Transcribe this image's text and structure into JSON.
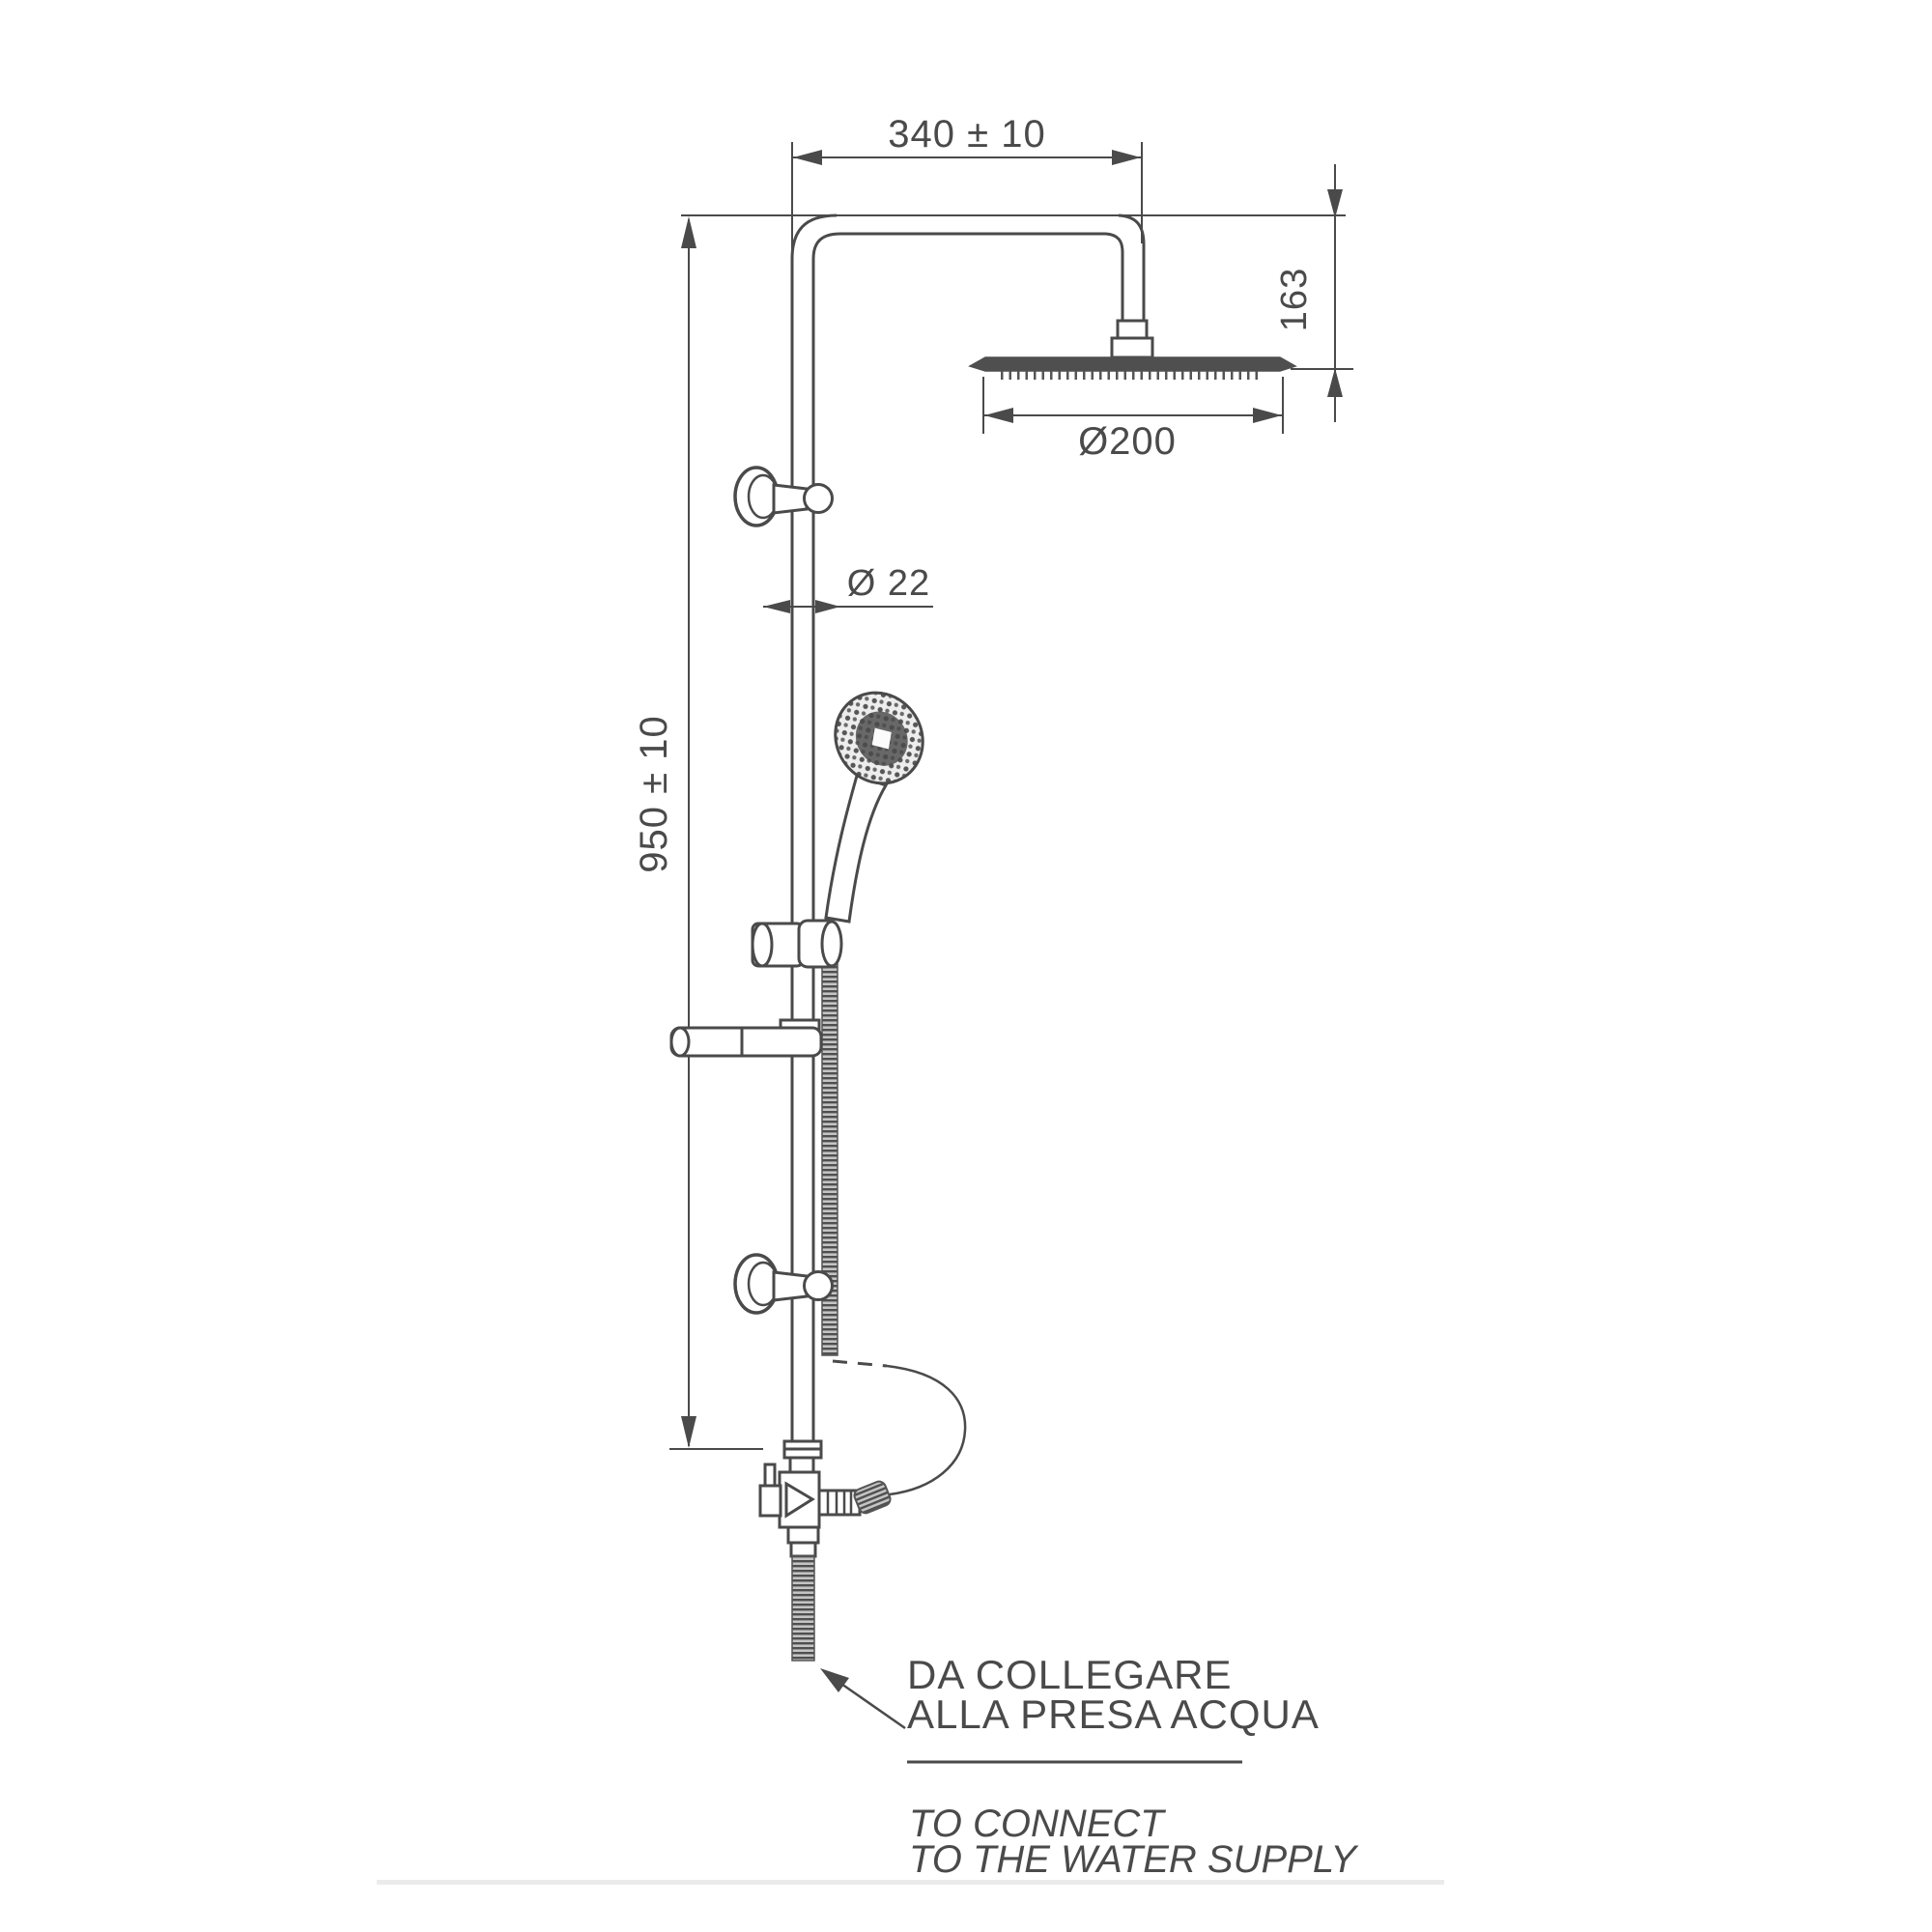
{
  "meta": {
    "type": "technical-installation-drawing",
    "subject": "shower column with rain head and hand shower"
  },
  "colors": {
    "line": "#4a4a4a",
    "background": "#ffffff",
    "fill_dark": "#4f4f4f"
  },
  "dimensions": {
    "arm_width": "340 ± 10",
    "head_drop": "163",
    "head_diameter": "Ø200",
    "pipe_diameter": "Ø 22",
    "column_height": "950 ± 10"
  },
  "notes": {
    "it1": "DA COLLEGARE",
    "it2": "ALLA PRESA ACQUA",
    "en1": "TO CONNECT",
    "en2": "TO THE WATER SUPPLY"
  }
}
